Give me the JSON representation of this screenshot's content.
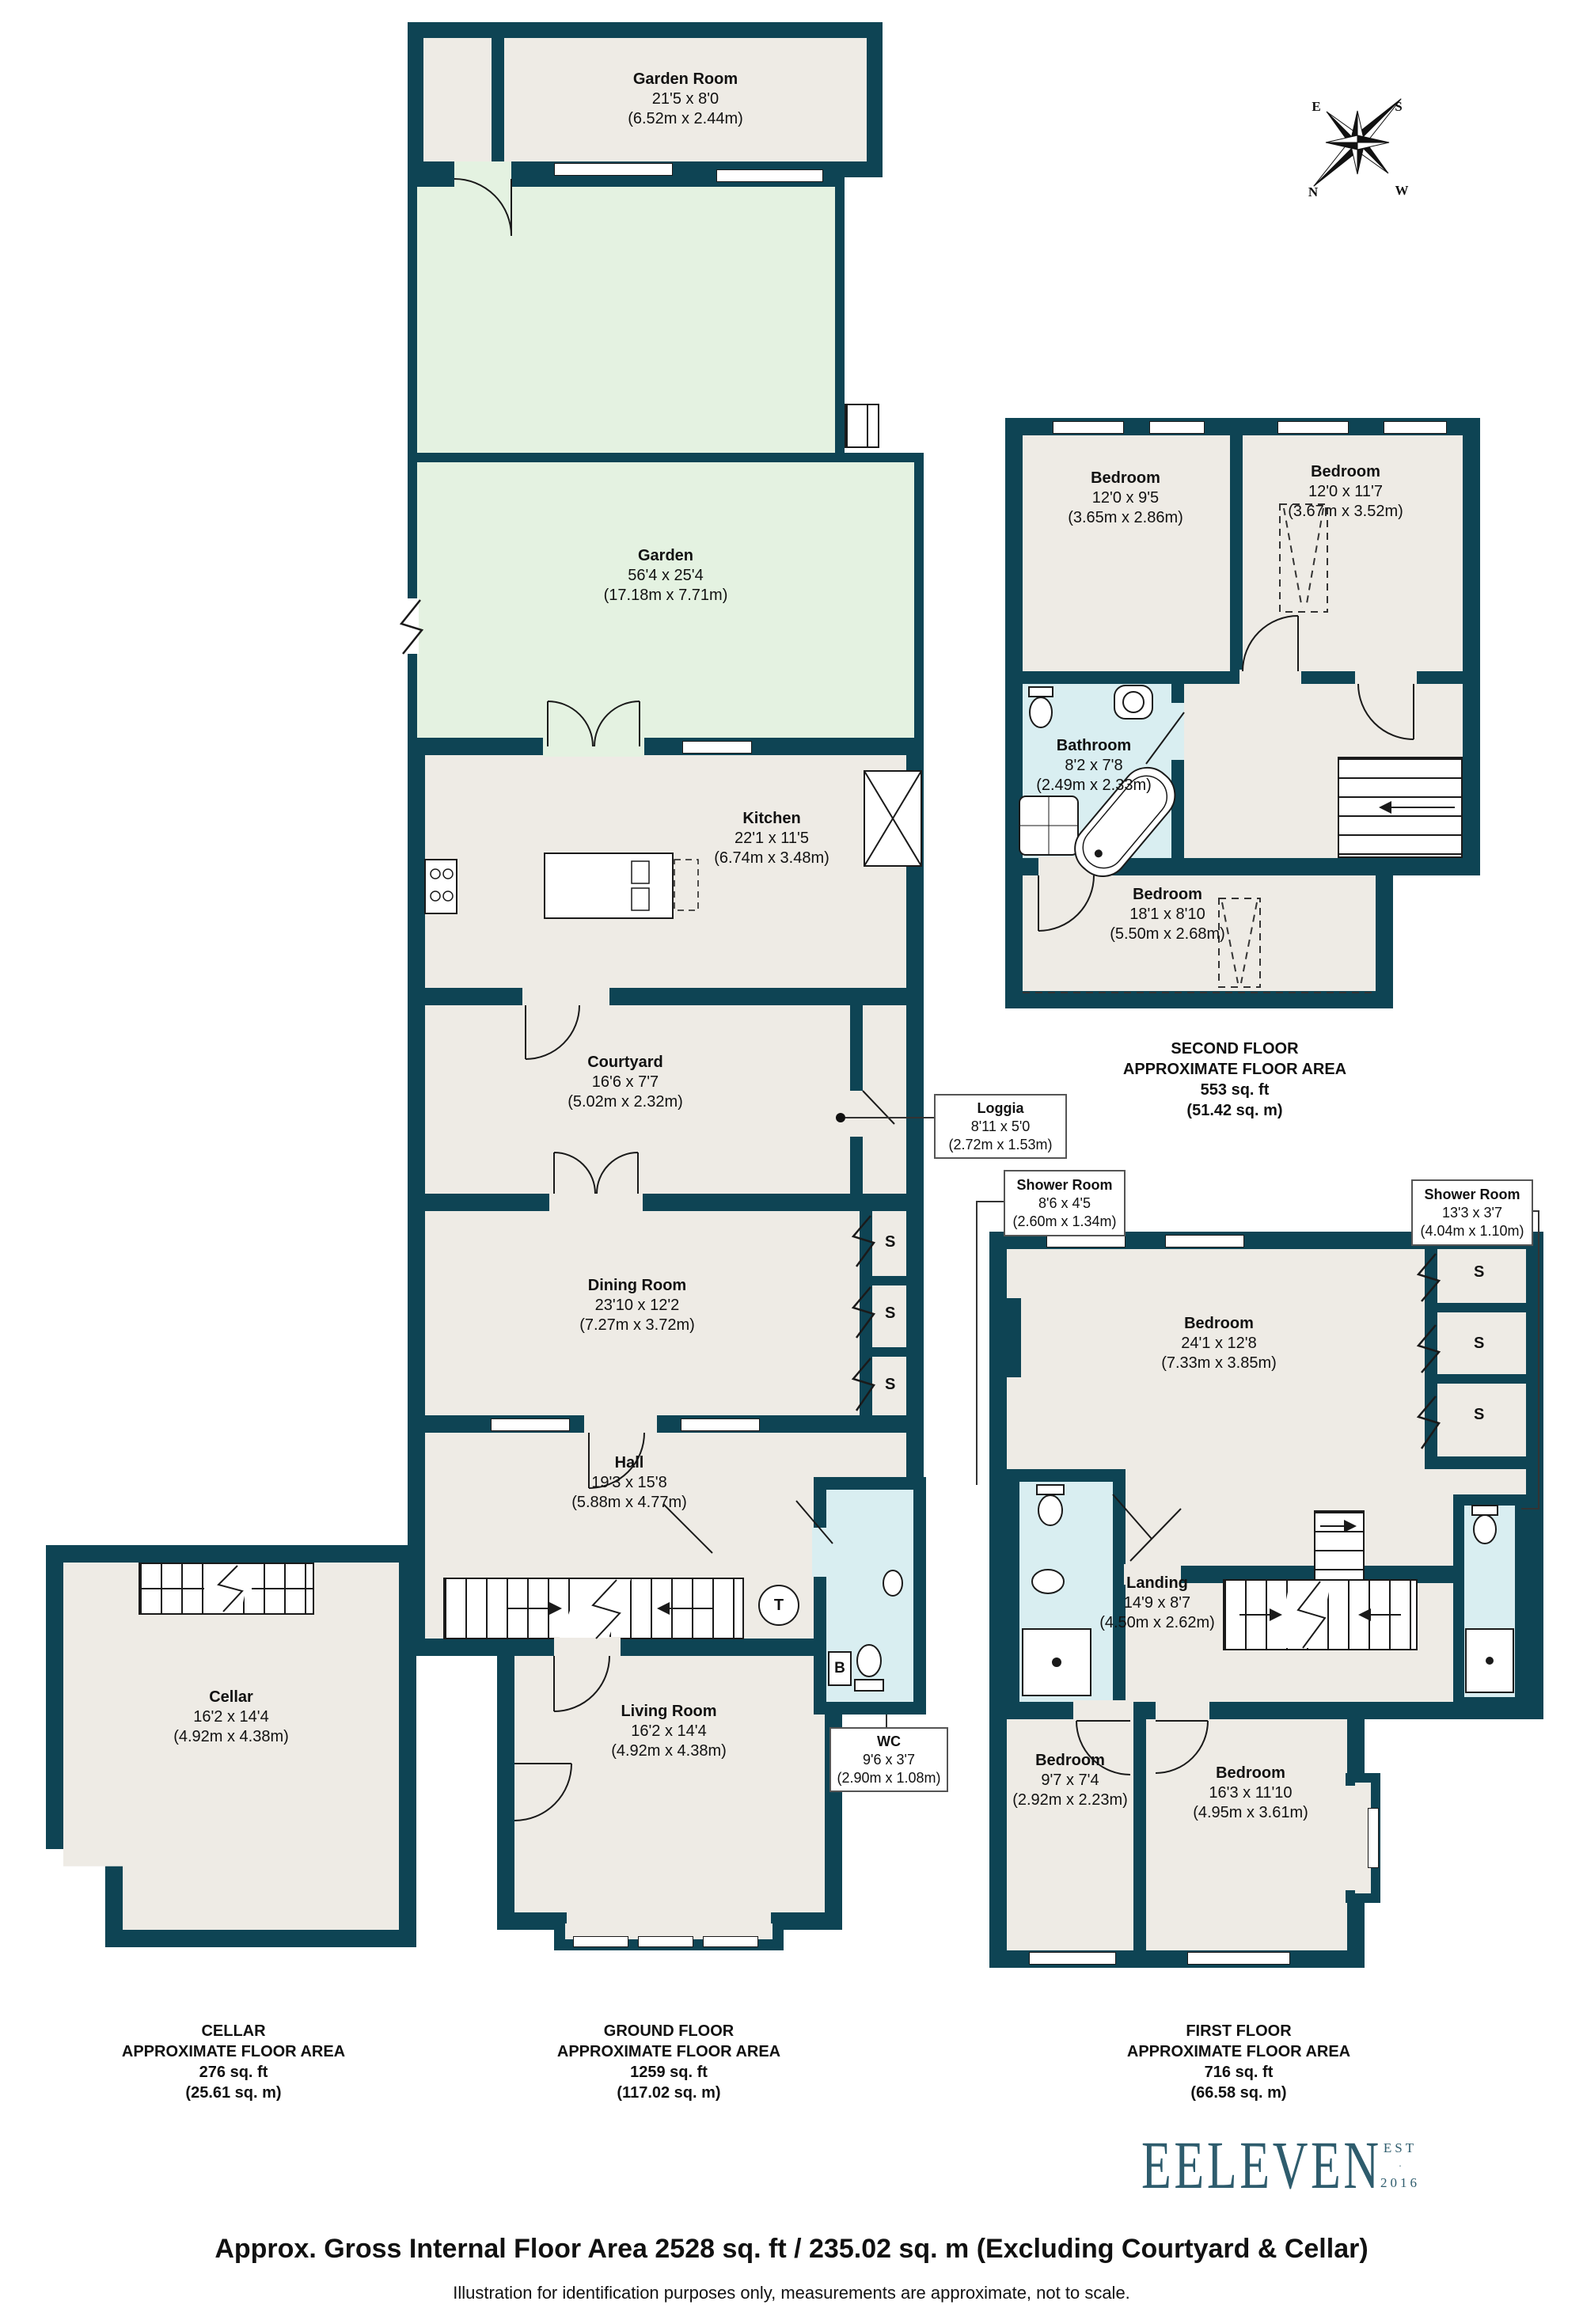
{
  "rooms": {
    "garden_room": {
      "name": "Garden Room",
      "imp": "21'5 x 8'0",
      "met": "(6.52m x 2.44m)"
    },
    "garden": {
      "name": "Garden",
      "imp": "56'4 x 25'4",
      "met": "(17.18m x 7.71m)"
    },
    "kitchen": {
      "name": "Kitchen",
      "imp": "22'1 x 11'5",
      "met": "(6.74m x 3.48m)"
    },
    "courtyard": {
      "name": "Courtyard",
      "imp": "16'6 x 7'7",
      "met": "(5.02m x 2.32m)"
    },
    "loggia": {
      "name": "Loggia",
      "imp": "8'11 x 5'0",
      "met": "(2.72m x 1.53m)"
    },
    "dining_room": {
      "name": "Dining Room",
      "imp": "23'10 x 12'2",
      "met": "(7.27m x 3.72m)"
    },
    "hall": {
      "name": "Hall",
      "imp": "19'3 x 15'8",
      "met": "(5.88m x 4.77m)"
    },
    "living_room": {
      "name": "Living Room",
      "imp": "16'2 x 14'4",
      "met": "(4.92m x 4.38m)"
    },
    "wc": {
      "name": "WC",
      "imp": "9'6 x 3'7",
      "met": "(2.90m x 1.08m)"
    },
    "cellar": {
      "name": "Cellar",
      "imp": "16'2 x 14'4",
      "met": "(4.92m x 4.38m)"
    },
    "bedroom2_left": {
      "name": "Bedroom",
      "imp": "12'0 x 9'5",
      "met": "(3.65m x 2.86m)"
    },
    "bedroom2_right": {
      "name": "Bedroom",
      "imp": "12'0 x 11'7",
      "met": "(3.67m x 3.52m)"
    },
    "bathroom": {
      "name": "Bathroom",
      "imp": "8'2 x 7'8",
      "met": "(2.49m x 2.33m)"
    },
    "bedroom2_rear": {
      "name": "Bedroom",
      "imp": "18'1 x 8'10",
      "met": "(5.50m x 2.68m)"
    },
    "shower_left": {
      "name": "Shower Room",
      "imp": "8'6 x 4'5",
      "met": "(2.60m x 1.34m)"
    },
    "shower_right": {
      "name": "Shower Room",
      "imp": "13'3 x 3'7",
      "met": "(4.04m x 1.10m)"
    },
    "bedroom1_main": {
      "name": "Bedroom",
      "imp": "24'1 x 12'8",
      "met": "(7.33m x 3.85m)"
    },
    "landing": {
      "name": "Landing",
      "imp": "14'9 x 8'7",
      "met": "(4.50m x 2.62m)"
    },
    "bedroom1_small": {
      "name": "Bedroom",
      "imp": "9'7 x 7'4",
      "met": "(2.92m x 2.23m)"
    },
    "bedroom1_rear": {
      "name": "Bedroom",
      "imp": "16'3 x 11'10",
      "met": "(4.95m x 3.61m)"
    }
  },
  "floor_areas": {
    "cellar": {
      "title": "CELLAR",
      "subtitle": "APPROXIMATE FLOOR AREA",
      "sqft": "276 sq. ft",
      "sqm": "(25.61 sq. m)"
    },
    "ground": {
      "title": "GROUND FLOOR",
      "subtitle": "APPROXIMATE FLOOR AREA",
      "sqft": "1259 sq. ft",
      "sqm": "(117.02 sq. m)"
    },
    "first": {
      "title": "FIRST FLOOR",
      "subtitle": "APPROXIMATE FLOOR AREA",
      "sqft": "716 sq. ft",
      "sqm": "(66.58 sq. m)"
    },
    "second": {
      "title": "SECOND FLOOR",
      "subtitle": "APPROXIMATE FLOOR AREA",
      "sqft": "553 sq. ft",
      "sqm": "(51.42 sq. m)"
    }
  },
  "labels": {
    "storage": "S",
    "tank": "T",
    "boiler": "B"
  },
  "compass": {
    "n": "N",
    "e": "E",
    "s": "S",
    "w": "W"
  },
  "logo": {
    "name": "EELEVEN",
    "est": "EST",
    "dot": "·",
    "year": "2016"
  },
  "footer": {
    "gross": "Approx. Gross Internal Floor Area 2528 sq. ft / 235.02 sq. m (Excluding Courtyard & Cellar)",
    "disclaimer": "Illustration for identification purposes only, measurements are approximate, not to scale."
  },
  "colors": {
    "wall": "#0e4454",
    "room": "#eeebe5",
    "garden": "#e4f2e1",
    "bath": "#d9eef1",
    "logo": "#2e5c6d"
  }
}
